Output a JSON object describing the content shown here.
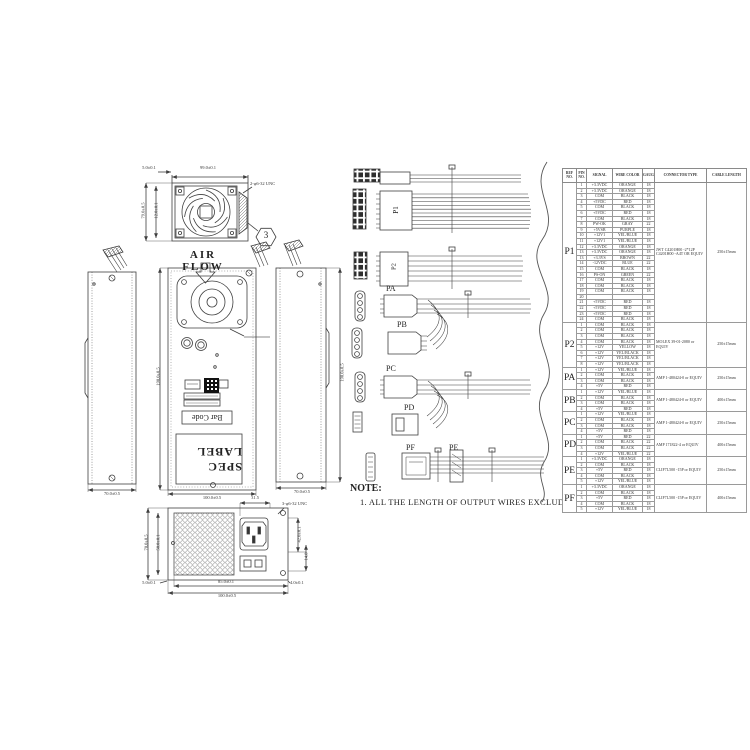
{
  "note": {
    "title": "NOTE:",
    "line1": "1. ALL THE LENGTH OF OUTPUT WIRES EXCLUDE HOUSING."
  },
  "drawings": {
    "air_flow": "AIR FLOW",
    "balloon": "3",
    "fan_view": {
      "dim_top": "99.0±0.1",
      "dim_top_left": "5.0±0.1",
      "dim_left_outer": "79.0±0.5",
      "dim_left_inner": "12.0±0.1",
      "callout": "2-φ6-32 UNC"
    },
    "front_view": {
      "spec_label": "SPEC LABEL",
      "bar_code": "Bar Code",
      "dim_height": "190.0±0.5",
      "dim_width": "100.0±0.5"
    },
    "side_left": {
      "dim_width": "70.0±0.5"
    },
    "side_right": {
      "dim_width": "70.0±0.5",
      "dim_height": "190.0±0.5"
    },
    "rear_view": {
      "dim_top": "31.5",
      "callout": "3-φ6-32 UNC",
      "dim_left_outer": "70.0±0.5",
      "dim_left_inner": "50.0±0.1",
      "dim_bottom_inner": "85.0±0.1",
      "dim_bottom_outer": "100.0±0.5",
      "dim_corner_left": "5.0±0.1",
      "dim_corner_right": "4.0±0.1",
      "dim_right_1": "42.0±0.1",
      "dim_right_2": "14.8"
    }
  },
  "harness": {
    "p1": "P1",
    "p2": "P2",
    "pa": "PA",
    "pb": "PB",
    "pc": "PC",
    "pd": "PD",
    "pe": "PE",
    "pf": "PF"
  },
  "table": {
    "headers": [
      "REF NO.",
      "PIN NO.",
      "SIGNAL",
      "WIRE COLOR",
      "GAUGE",
      "CONNECTOR TYPE",
      "CABLE LENGTH"
    ],
    "sections": [
      {
        "ref": "P1",
        "connector": "JWT C4201H00 -2*12P C4201H00 -A4T OR EQUIV",
        "length": "250±15mm",
        "rows": [
          [
            "1",
            "+3.3VDC",
            "ORANGE",
            "18"
          ],
          [
            "2",
            "+3.3VDC",
            "ORANGE",
            "18"
          ],
          [
            "3",
            "COM",
            "BLACK",
            "18"
          ],
          [
            "4",
            "+5VDC",
            "RED",
            "18"
          ],
          [
            "5",
            "COM",
            "BLACK",
            "18"
          ],
          [
            "6",
            "+5VDC",
            "RED",
            "18"
          ],
          [
            "7",
            "COM",
            "BLACK",
            "18"
          ],
          [
            "8",
            "PW-OK",
            "GRAY",
            "22"
          ],
          [
            "9",
            "+5VSB",
            "PURPLE",
            "18"
          ],
          [
            "10",
            "+12V1",
            "YEL/BLUE",
            "18"
          ],
          [
            "11",
            "+12V1",
            "YEL/BLUE",
            "18"
          ],
          [
            "12",
            "+3.3VDC",
            "ORANGE",
            "18"
          ],
          [
            "13",
            "+3.3VDC",
            "ORANGE",
            "18"
          ],
          [
            "13",
            "+3.3VS",
            "BROWN",
            "22"
          ],
          [
            "14",
            "-12VDC",
            "BLUE",
            "22"
          ],
          [
            "15",
            "COM",
            "BLACK",
            "18"
          ],
          [
            "16",
            "PS-ON",
            "GREEN",
            "22"
          ],
          [
            "17",
            "COM",
            "BLACK",
            "18"
          ],
          [
            "18",
            "COM",
            "BLACK",
            "18"
          ],
          [
            "19",
            "COM",
            "BLACK",
            "18"
          ],
          [
            "20",
            "",
            "",
            ""
          ],
          [
            "21",
            "+5VDC",
            "RED",
            "18"
          ],
          [
            "22",
            "+5VDC",
            "RED",
            "18"
          ],
          [
            "23",
            "+5VDC",
            "RED",
            "18"
          ],
          [
            "24",
            "COM",
            "BLACK",
            "18"
          ]
        ]
      },
      {
        "ref": "P2",
        "connector": "MOLEX 39-01-2080 or EQUIV",
        "length": "250±15mm",
        "rows": [
          [
            "1",
            "COM",
            "BLACK",
            "18"
          ],
          [
            "2",
            "COM",
            "BLACK",
            "18"
          ],
          [
            "3",
            "COM",
            "BLACK",
            "18"
          ],
          [
            "4",
            "COM",
            "BLACK",
            "18"
          ],
          [
            "5",
            "+12V",
            "YELLOW",
            "18"
          ],
          [
            "6",
            "+12V",
            "YEL/BLACK",
            "18"
          ],
          [
            "7",
            "+12V",
            "YEL/BLACK",
            "18"
          ],
          [
            "8",
            "+12V",
            "YEL/BLACK",
            "18"
          ]
        ]
      },
      {
        "ref": "PA",
        "connector": "AMP 1-480424-0 or EQUIV",
        "length": "250±15mm",
        "rows": [
          [
            "1",
            "+12V",
            "YEL/BLUE",
            "18"
          ],
          [
            "2",
            "COM",
            "BLACK",
            "18"
          ],
          [
            "3",
            "COM",
            "BLACK",
            "18"
          ],
          [
            "4",
            "+5V",
            "RED",
            "18"
          ]
        ]
      },
      {
        "ref": "PB",
        "connector": "AMP 1-480424-0 or EQUIV",
        "length": "400±15mm",
        "rows": [
          [
            "1",
            "+12V",
            "YEL/BLUE",
            "18"
          ],
          [
            "2",
            "COM",
            "BLACK",
            "18"
          ],
          [
            "3",
            "COM",
            "BLACK",
            "18"
          ],
          [
            "4",
            "+5V",
            "RED",
            "18"
          ]
        ]
      },
      {
        "ref": "PC",
        "connector": "AMP 1-480424-0 or EQUIV",
        "length": "250±15mm",
        "rows": [
          [
            "1",
            "+12V",
            "YEL/BLUE",
            "18"
          ],
          [
            "2",
            "COM",
            "BLACK",
            "18"
          ],
          [
            "3",
            "COM",
            "BLACK",
            "18"
          ],
          [
            "4",
            "+5V",
            "RED",
            "18"
          ]
        ]
      },
      {
        "ref": "PD",
        "connector": "AMP 171822-4 or EQUIV",
        "length": "400±15mm",
        "rows": [
          [
            "1",
            "+5V",
            "RED",
            "22"
          ],
          [
            "2",
            "COM",
            "BLACK",
            "22"
          ],
          [
            "3",
            "COM",
            "BLACK",
            "22"
          ],
          [
            "4",
            "+12V",
            "YEL/BLUE",
            "22"
          ]
        ]
      },
      {
        "ref": "PE",
        "connector": "CLIF7L500 -15P or EQUIV",
        "length": "250±15mm",
        "rows": [
          [
            "1",
            "+3.3VDC",
            "ORANGE",
            "18"
          ],
          [
            "2",
            "COM",
            "BLACK",
            "18"
          ],
          [
            "3",
            "+5V",
            "RED",
            "18"
          ],
          [
            "4",
            "COM",
            "BLACK",
            "18"
          ],
          [
            "5",
            "+12V",
            "YEL/BLUE",
            "18"
          ]
        ]
      },
      {
        "ref": "PF",
        "connector": "CLIF7L500 -15P or EQUIV",
        "length": "400±15mm",
        "rows": [
          [
            "1",
            "+3.3VDC",
            "ORANGE",
            "18"
          ],
          [
            "2",
            "COM",
            "BLACK",
            "18"
          ],
          [
            "3",
            "+5V",
            "RED",
            "18"
          ],
          [
            "4",
            "COM",
            "BLACK",
            "18"
          ],
          [
            "5",
            "+12V",
            "YEL/BLUE",
            "18"
          ]
        ]
      }
    ]
  }
}
